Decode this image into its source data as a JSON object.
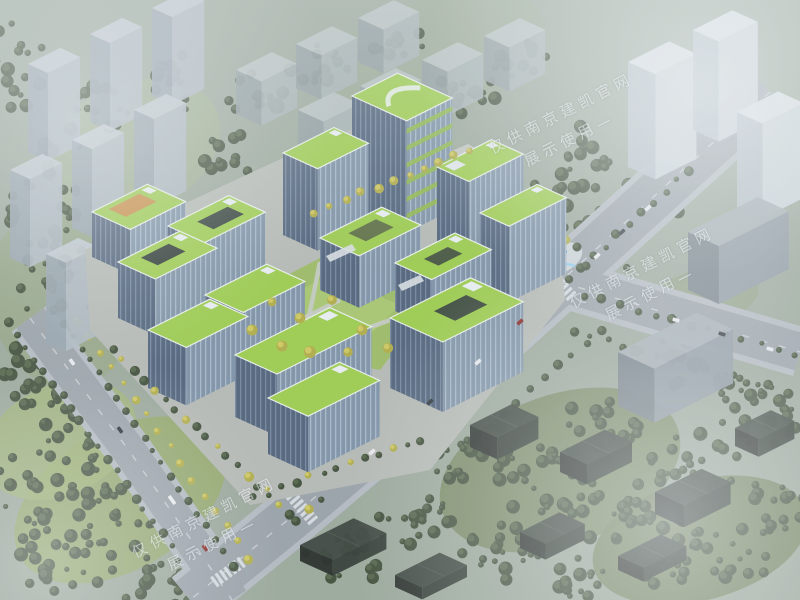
{
  "scene": {
    "description": "Aerial architectural rendering of a green-roof office campus with a high-rise tower, surrounded by tree-lined roads, a blue plaza sculpture, and hazy grey city blocks in fog",
    "watermark": {
      "line1": "仅供南京建凯官网",
      "line2": "展示使用—",
      "style": {
        "color": "#ffffff",
        "opacity": 0.52,
        "rotation_deg": -27
      }
    },
    "palette": {
      "green_roof": "#9ccc4e",
      "facade_dark": "#51637a",
      "facade_light": "#7e93a6",
      "context_grey": "#aeb9c0",
      "road_grey": "#99a2a8",
      "tree_dark": "#3e4d38",
      "tree_yellow": "#c4bd55",
      "lawn_green": "#9cba62",
      "water_blue": "#5aa7d8",
      "fog_white": "#eef2f4"
    }
  }
}
